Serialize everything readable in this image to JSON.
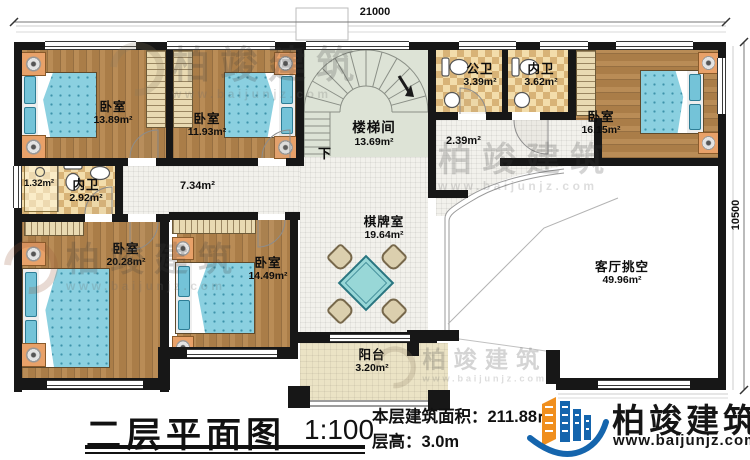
{
  "dimensions": {
    "top_width": "21000",
    "right_height": "10500"
  },
  "rooms": {
    "bedroom_tl": {
      "name": "卧室",
      "area": "13.89m²"
    },
    "bedroom_tm": {
      "name": "卧室",
      "area": "11.93m²"
    },
    "bedroom_tr": {
      "name": "卧室",
      "area": "16.15m²"
    },
    "bedroom_bl": {
      "name": "卧室",
      "area": "20.28m²"
    },
    "bedroom_bm": {
      "name": "卧室",
      "area": "14.49m²"
    },
    "public_bath": {
      "name": "公卫",
      "area": "3.39m²"
    },
    "ensuite_top": {
      "name": "内卫",
      "area": "3.62m²"
    },
    "ensuite_left": {
      "name": "内卫",
      "area": "2.92m²",
      "shower_area": "1.32m²"
    },
    "stair_hall": {
      "name": "楼梯间",
      "area": "13.69m²",
      "down_label": "下"
    },
    "hallway": {
      "area": "7.34m²"
    },
    "hallway_small": {
      "area": "2.39m²"
    },
    "game_room": {
      "name": "棋牌室",
      "area": "19.64m²"
    },
    "balcony": {
      "name": "阳台",
      "area": "3.20m²"
    },
    "living_void": {
      "name": "客厅挑空",
      "area": "49.96m²"
    }
  },
  "annotation": {
    "title": "二层平面图",
    "scale": "1:100",
    "floor_area": "本层建筑面积：211.88㎡",
    "floor_height": "层高：3.0m"
  },
  "brand": {
    "name": "柏竣建筑",
    "website": "www.baijunjz.com"
  },
  "watermark": {
    "name": "柏竣建筑",
    "website": "www.baijunjz.com"
  },
  "colors": {
    "wall": "#171717",
    "wood": "#b5854c",
    "bath_tile": "#f3ddab",
    "stair_floor": "#dde3d6",
    "bed_fabric": "#8bd0e0",
    "brand_blue": "#1565ad",
    "brand_orange": "#f08f1e"
  }
}
